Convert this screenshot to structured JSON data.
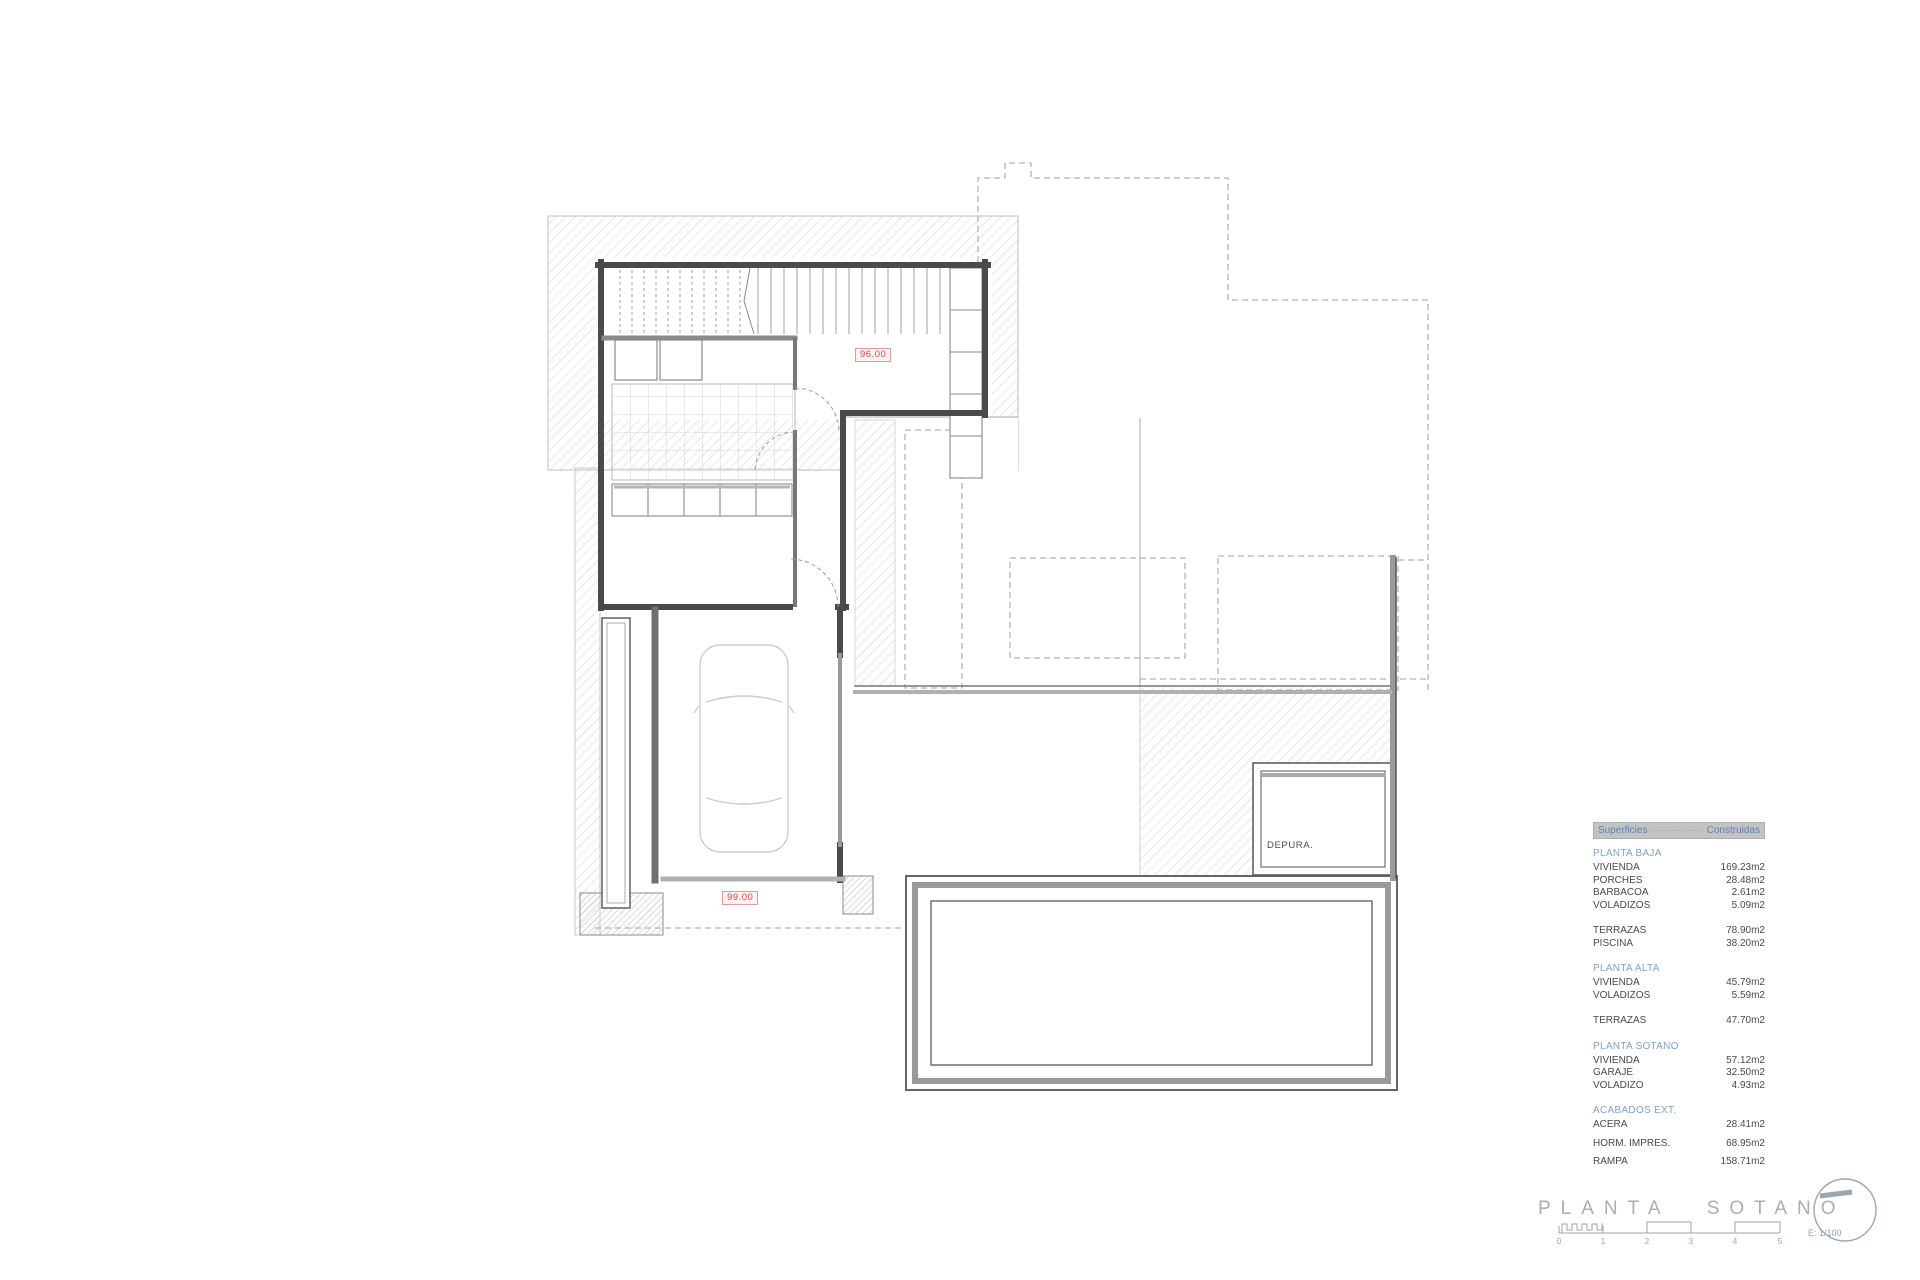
{
  "plan": {
    "level_label_upper": "96.00",
    "level_label_lower": "99.00",
    "room_label_depuradora": "DEPURA."
  },
  "areas_table": {
    "header": {
      "col_left": "Superficies",
      "col_right": "Construidas"
    },
    "sections": [
      {
        "heading": "PLANTA BAJA",
        "rows": [
          {
            "label": "VIVIENDA",
            "value": "169.23m2"
          },
          {
            "label": "PORCHES",
            "value": "28.48m2"
          },
          {
            "label": "BARBACOA",
            "value": "2.61m2"
          },
          {
            "label": "VOLADIZOS",
            "value": "5.09m2"
          }
        ]
      },
      {
        "heading": "",
        "rows": [
          {
            "label": "TERRAZAS",
            "value": "78.90m2"
          },
          {
            "label": "PISCINA",
            "value": "38.20m2"
          }
        ]
      },
      {
        "heading": "PLANTA ALTA",
        "rows": [
          {
            "label": "VIVIENDA",
            "value": "45.79m2"
          },
          {
            "label": "VOLADIZOS",
            "value": "5.59m2"
          }
        ]
      },
      {
        "heading": "",
        "rows": [
          {
            "label": "TERRAZAS",
            "value": "47.70m2"
          }
        ]
      },
      {
        "heading": "PLANTA SOTANO",
        "rows": [
          {
            "label": "VIVIENDA",
            "value": "57.12m2"
          },
          {
            "label": "GARAJE",
            "value": "32.50m2"
          },
          {
            "label": "VOLADIZO",
            "value": "4.93m2"
          }
        ]
      },
      {
        "heading": "ACABADOS EXT.",
        "rows": [
          {
            "label": "ACERA",
            "value": "28.41m2"
          },
          {
            "label": "HORM. IMPRES.",
            "value": "68.95m2"
          },
          {
            "label": "RAMPA",
            "value": "158.71m2"
          }
        ]
      }
    ]
  },
  "title_block": {
    "title": "PLANTA SOTANO",
    "scale_label": "E: 1/100",
    "scale_ticks": [
      "0",
      "1",
      "2",
      "3",
      "4",
      "5"
    ]
  },
  "colors": {
    "wall_dark": "#4a4a4a",
    "wall_gray": "#9a9a9a",
    "hatch": "#d2d2d2",
    "dashed_outline": "#b3b3b3",
    "level_red": "#d14b4b",
    "heading_blue": "#7fa3cc",
    "header_bar_bg": "#c3c3c3",
    "title_gray": "#a9aeb4"
  }
}
